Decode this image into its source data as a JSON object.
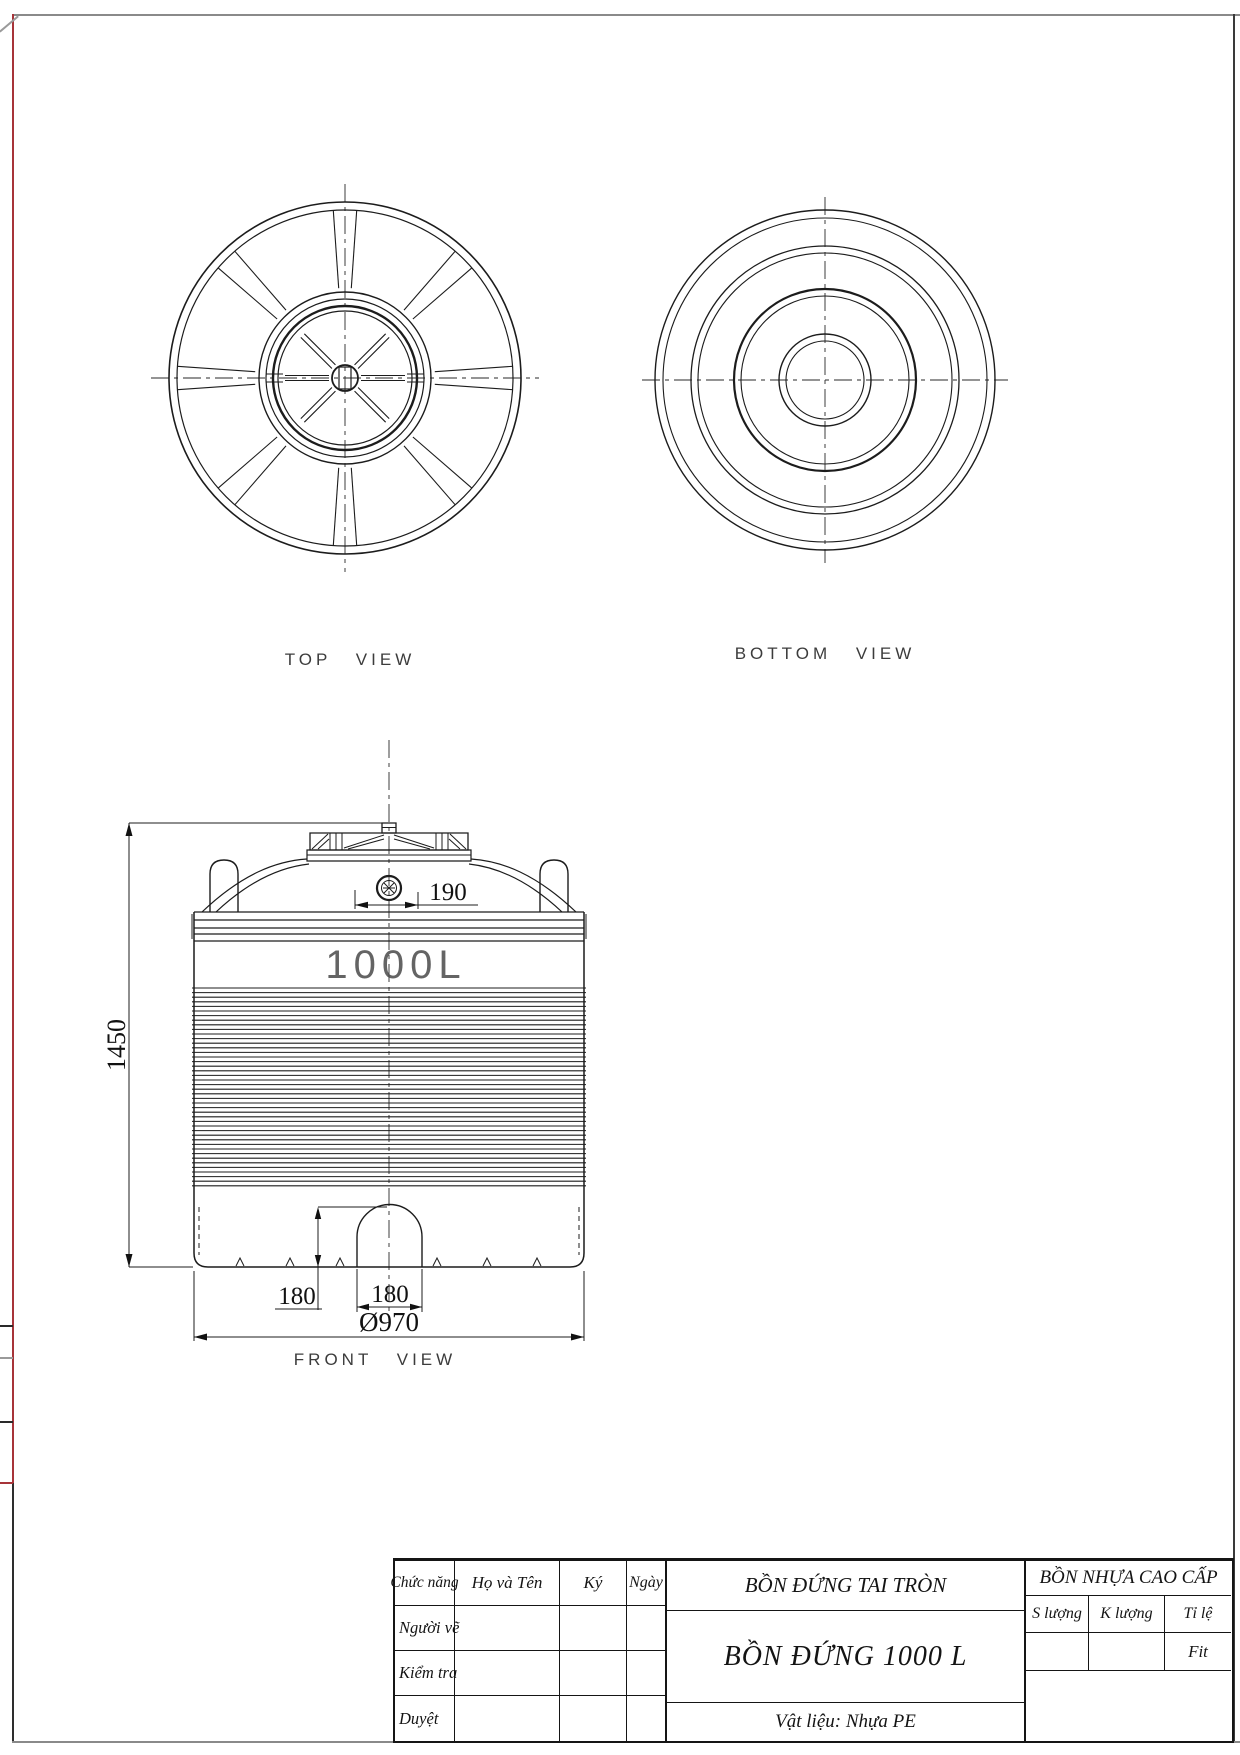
{
  "views": {
    "top": {
      "label": "TOP VIEW"
    },
    "bottom": {
      "label": "BOTTOM VIEW"
    },
    "front": {
      "label": "FRONT VIEW",
      "capacity": "1000L"
    }
  },
  "dimensions": {
    "overall_height": "1450",
    "manhole_width": "190",
    "drain_height": "180",
    "drain_width": "180",
    "diameter": "Ø970"
  },
  "title_block": {
    "col_role": "Chức năng",
    "col_name": "Họ và Tên",
    "col_sign": "Ký",
    "col_date": "Ngày",
    "row_drafter": "Người vẽ",
    "row_checker": "Kiểm tra",
    "row_approver": "Duyệt",
    "product_type": "BỒN ĐỨNG TAI TRÒN",
    "product_title": "BỒN ĐỨNG 1000 L",
    "material": "Vật liệu: Nhựa PE",
    "company": "BỒN NHỰA CAO CẤP",
    "qty_label": "S lượng",
    "weight_label": "K lượng",
    "scale_label": "Tỉ lệ",
    "scale_value": "Fit"
  }
}
